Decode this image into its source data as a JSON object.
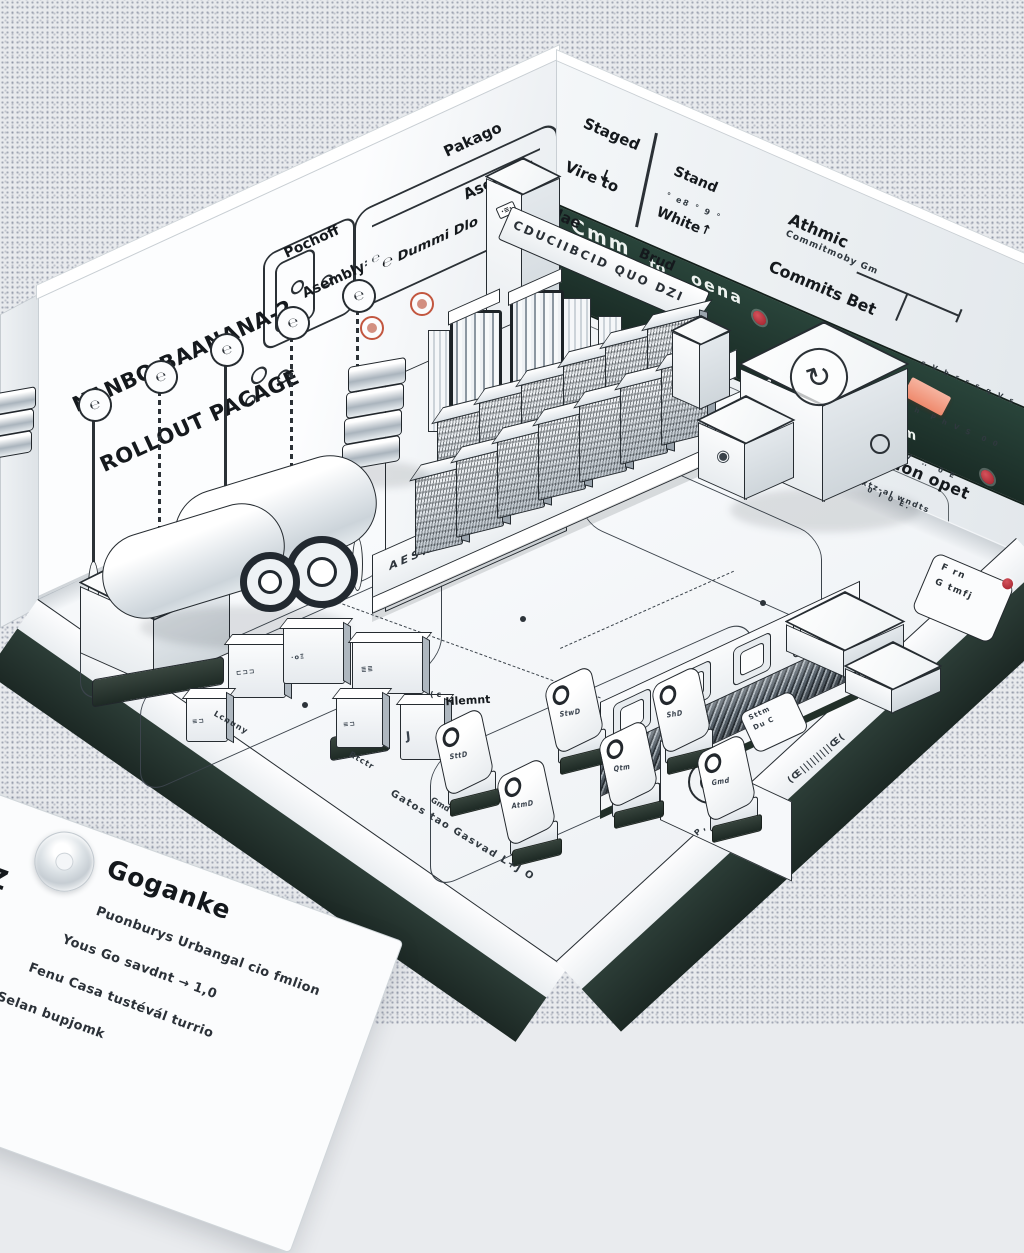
{
  "left_wall": {
    "title": {
      "line1": "NANBO BAANANA-2",
      "line2": "ROLLOUT PACAGE"
    },
    "pochoff": {
      "line1": "Pochoff",
      "line2": "Asembly"
    },
    "dummi_box": {
      "colon": ": ℮",
      "note": "℮ Dummi Dlo"
    },
    "pakago": {
      "line1": "Pakago",
      "line2": "Asembay"
    },
    "pins": {
      "glyph": "℮"
    },
    "tower_chip": "·≡·"
  },
  "right_wall": {
    "staged": {
      "line1": "Staged",
      "line2": "Vire to",
      "line3": "Slae",
      "arrow": "↓"
    },
    "stand": {
      "line1": "Stand",
      "line2": "White",
      "line3": "Brud",
      "dots": "° e8 ° 9 °",
      "arrow": "↑"
    },
    "athmic": {
      "line1": "Athmic",
      "line2": "Commits Bet",
      "sub": "Commitmoby Gm"
    },
    "sfx": {
      "title": "Sfxalirtion opet",
      "sub": "Fcs vxtz-al wndts"
    },
    "note": {
      "l1": "s V b r r s q V s",
      "l2": "F h  P h V S  0 0",
      "l3": "I E V  ∴  0 E",
      "l4": "0 I 0 E."
    },
    "tag_box": {
      "l1": "F rn",
      "l2": "G tmfj"
    },
    "banner": {
      "s1": "Cmm",
      "s2": "to",
      "s3": "oena",
      "s4": "£ m"
    }
  },
  "beam_text": "CDUCIIBCID QUO DZI",
  "platform_edge": "AESNUO UMMMM",
  "floor": {
    "hlemnt": {
      "pre": "( c",
      "line1": "Hlemnt",
      "line2": "oxo"
    },
    "gatos": "Gatos tao Gasvad L+J O",
    "edge_text": "(Œ|||||||||Œ(",
    "edge_text2": "Р ,",
    "labels": {
      "lcnuny": "Lcnuny",
      "rtctr": "Rtctr",
      "gmd": "Gmd"
    }
  },
  "tags": {
    "t1": "SttD",
    "t2": "AtmD",
    "t3": "StwD",
    "t4": "Qtm",
    "t5": "ShD",
    "t6": "Gmd"
  },
  "micro": {
    "m1": "⊏⊐⊐",
    "m2": "J",
    "m3": "≣≣",
    "m4": "≡⊐",
    "m5": "·oΞ"
  },
  "floor_tag": {
    "l1": "Sttm",
    "l2": "Du C"
  },
  "card": {
    "heading": "Goganke",
    "z_mark": "Z",
    "line1": "Puonburys Urbangal cio fmlion",
    "line2": "Yous Go savdnt → 1,0",
    "line3": "Fenu Casa tustévál turrio",
    "line4": "Selan bupjomk"
  },
  "glyphs": {
    "cube": "↻",
    "spiral": "◉"
  },
  "colors": {
    "banner": "#203530",
    "skirt": "#243430",
    "red": "#b02b33",
    "orange": "#f0927b",
    "ink": "#23282d"
  }
}
